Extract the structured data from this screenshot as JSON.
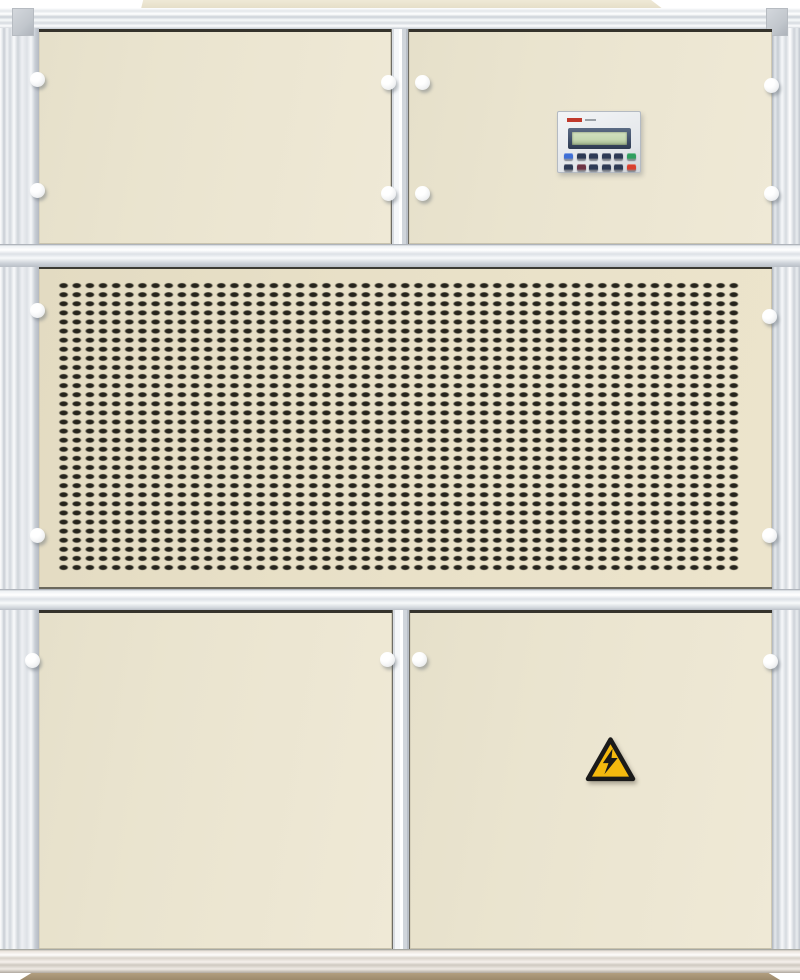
{
  "meta": {
    "subject": "Industrial packaged air-handling / dehumidifier unit, front view photo",
    "sections": [
      "top access panels",
      "controller keypad",
      "ventilation grille",
      "bottom access doors",
      "aluminum frame",
      "base plinth"
    ]
  },
  "colors": {
    "cream": "#eae4cf",
    "cream_grille": "#e8e0c7",
    "slot": "#26241c",
    "knob": "#f4f5f6",
    "bezel": "#41506a",
    "lcd": "#c4d6b0",
    "logo_red": "#c0392b",
    "warn_yellow": "#f4b90e",
    "warn_black": "#1a1a1a",
    "base_tan": "#b29e7f"
  },
  "controller": {
    "display_text": "",
    "keypad": {
      "rows": [
        [
          "#3f6fd6",
          "#2d3a55",
          "#2d3a55",
          "#2d3a55",
          "#2d3a55",
          "#2f9e5f"
        ],
        [
          "#2d3a55",
          "#6e3546",
          "#2d3a55",
          "#2d3a55",
          "#2d3a55",
          "#d8402f"
        ]
      ]
    }
  },
  "grille": {
    "slot_columns": 52,
    "slot_rows": 32
  },
  "warning_sign": {
    "type": "high-voltage",
    "shape": "triangle-with-lightning-bolt"
  },
  "latch_knob_count": 16
}
